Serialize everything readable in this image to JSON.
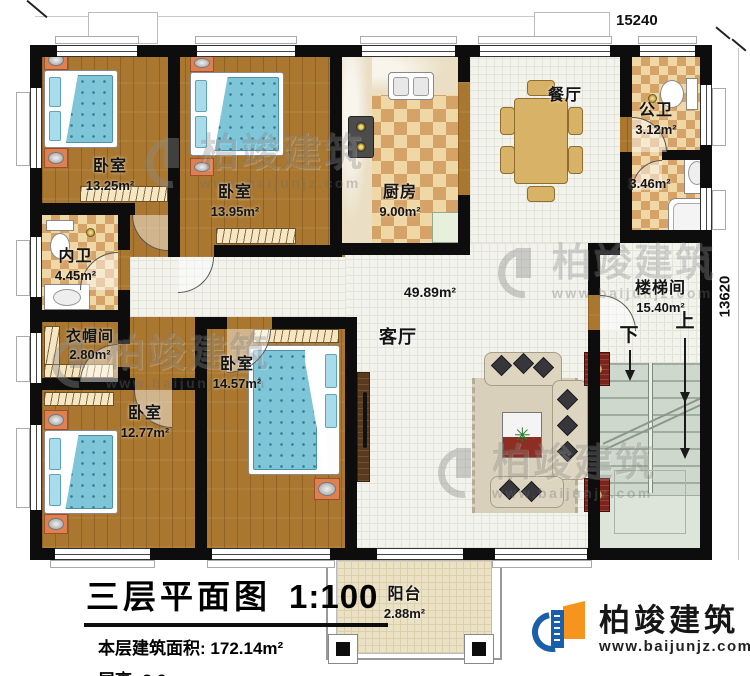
{
  "plan": {
    "dim_top": "15240",
    "dim_right": "13620",
    "rooms": {
      "bedroom1": {
        "name": "卧室",
        "area": "13.25m²"
      },
      "bedroom2": {
        "name": "卧室",
        "area": "13.95m²"
      },
      "kitchen": {
        "name": "厨房",
        "area": "9.00m²"
      },
      "dining": {
        "name": "餐厅"
      },
      "public_bath": {
        "name": "公卫",
        "area": "3.12m²"
      },
      "public_bath_lower": {
        "area": "3.46m²"
      },
      "private_bath": {
        "name": "内卫",
        "area": "4.45m²"
      },
      "cloakroom": {
        "name": "衣帽间",
        "area": "2.80m²"
      },
      "bedroom3": {
        "name": "卧室",
        "area": "14.57m²"
      },
      "bedroom4": {
        "name": "卧室",
        "area": "12.77m²"
      },
      "living": {
        "name": "客厅",
        "area": "49.89m²"
      },
      "stairwell": {
        "name": "楼梯间",
        "area": "15.40m²"
      },
      "balcony": {
        "name": "阳台",
        "area": "2.88m²"
      }
    },
    "stairs": {
      "up": "上",
      "down": "下"
    }
  },
  "title_block": {
    "title": "三层平面图",
    "scale": "1:100",
    "area_label": "本层建筑面积:",
    "area_value": "172.14m²",
    "floor_height_label": "层高:",
    "floor_height_value": "3.6m"
  },
  "branding": {
    "company": "柏竣建筑",
    "website": "www.baijunjz.com",
    "brand_blue": "#1b5fa8",
    "brand_orange": "#f7941d"
  },
  "watermark": {
    "text": "柏竣建筑",
    "url": "www.baijunjz.com"
  }
}
